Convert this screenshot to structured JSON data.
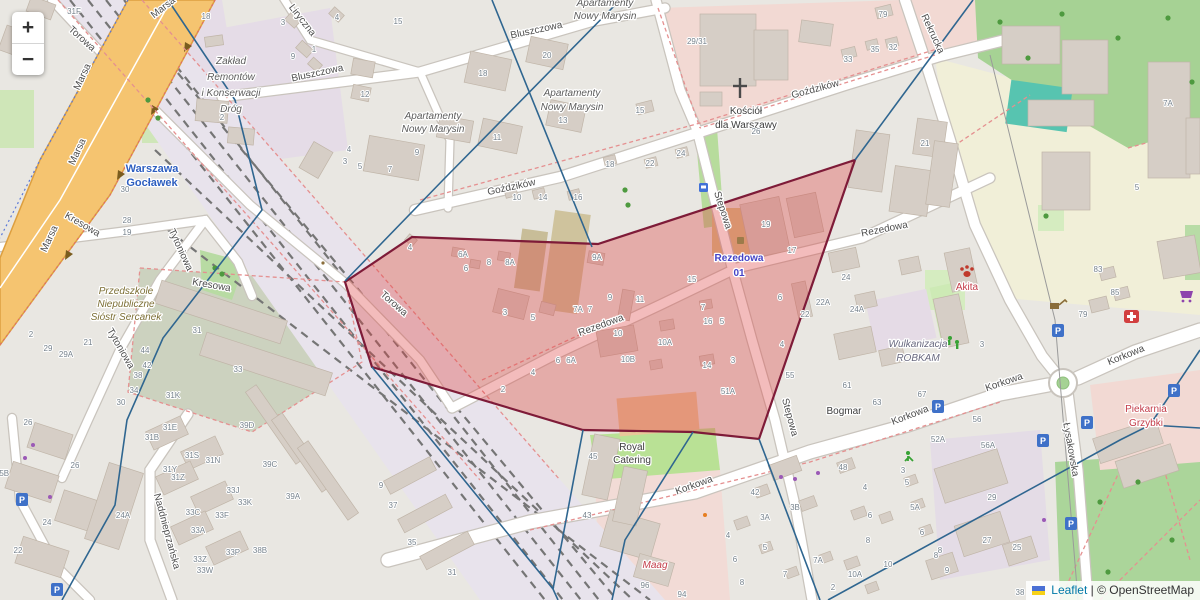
{
  "controls": {
    "zoom_in": "+",
    "zoom_out": "−"
  },
  "attribution": {
    "leaflet": "Leaflet",
    "separator": "|",
    "osm": "© OpenStreetMap"
  },
  "icons": {
    "parking_glyph": "P",
    "church_cross": "✝",
    "flag": "ukraine-flag"
  },
  "overlay": {
    "red_region_points": "345,282 412,237 598,244 855,160 759,439 693,432 583,430 372,367",
    "red_fill": "rgba(222,64,64,0.35)",
    "red_stroke": "#7e1b38",
    "line_color": "#2f6690",
    "boundary_lines": [
      "168,0 235,100 262,210 163,338 127,420 115,505 62,600",
      "620,0 443,180 345,281",
      "492,0 592,247",
      "973,0 855,160",
      "372,367 553,589 558,600",
      "583,430 553,589",
      "693,432 625,540 612,600",
      "759,439 820,600",
      "828,600 1120,440 1150,425 1200,350",
      "1150,425 1200,428"
    ]
  },
  "parkings": [
    [
      22,
      500
    ],
    [
      57,
      590
    ],
    [
      938,
      407
    ],
    [
      1043,
      441
    ],
    [
      1058,
      331
    ],
    [
      1071,
      524
    ],
    [
      1087,
      423
    ],
    [
      1174,
      391
    ]
  ],
  "streets": [
    {
      "t": "Marsa",
      "x": 165,
      "y": 10,
      "r": -38
    },
    {
      "t": "Marsa",
      "x": 85,
      "y": 78,
      "r": -65
    },
    {
      "t": "Marsa",
      "x": 80,
      "y": 153,
      "r": -65
    },
    {
      "t": "Marsa",
      "x": 52,
      "y": 240,
      "r": -65
    },
    {
      "t": "Torowa",
      "x": 80,
      "y": 41,
      "r": 42
    },
    {
      "t": "Torowa",
      "x": 392,
      "y": 306,
      "r": 41
    },
    {
      "t": "Liryczna",
      "x": 300,
      "y": 22,
      "r": 52
    },
    {
      "t": "Bluszczowa",
      "x": 318,
      "y": 76,
      "r": -12
    },
    {
      "t": "Bluszczowa",
      "x": 537,
      "y": 33,
      "r": -12
    },
    {
      "t": "Goździków",
      "x": 512,
      "y": 190,
      "r": -12
    },
    {
      "t": "Goździków",
      "x": 816,
      "y": 92,
      "r": -15
    },
    {
      "t": "Rezedowa",
      "x": 602,
      "y": 328,
      "r": -20
    },
    {
      "t": "Rezedowa",
      "x": 885,
      "y": 232,
      "r": -11
    },
    {
      "t": "Stepowa",
      "x": 720,
      "y": 211,
      "r": 72
    },
    {
      "t": "Stepowa",
      "x": 787,
      "y": 418,
      "r": 75
    },
    {
      "t": "Korkowa",
      "x": 695,
      "y": 488,
      "r": -20
    },
    {
      "t": "Korkowa",
      "x": 911,
      "y": 418,
      "r": -21
    },
    {
      "t": "Korkowa",
      "x": 1005,
      "y": 385,
      "r": -19
    },
    {
      "t": "Korkowa",
      "x": 1127,
      "y": 358,
      "r": -22
    },
    {
      "t": "Rekrucka",
      "x": 930,
      "y": 35,
      "r": 65
    },
    {
      "t": "Kresowa",
      "x": 81,
      "y": 227,
      "r": 30
    },
    {
      "t": "Kresowa",
      "x": 211,
      "y": 288,
      "r": 10
    },
    {
      "t": "Tytoniowa",
      "x": 178,
      "y": 251,
      "r": 65
    },
    {
      "t": "Tytoniowa",
      "x": 118,
      "y": 350,
      "r": 60
    },
    {
      "t": "Łysakowska",
      "x": 1068,
      "y": 450,
      "r": 80
    },
    {
      "t": "Naddnieprzańska",
      "x": 164,
      "y": 532,
      "r": 75
    }
  ],
  "pois": [
    {
      "t": "Zakład",
      "x": 231,
      "y": 64,
      "c": "g"
    },
    {
      "t": "Remontów",
      "x": 231,
      "y": 80,
      "c": "g"
    },
    {
      "t": "i Konserwacji",
      "x": 231,
      "y": 96,
      "c": "g"
    },
    {
      "t": "Dróg",
      "x": 231,
      "y": 112,
      "c": "g"
    },
    {
      "t": "Apartamenty",
      "x": 433,
      "y": 119,
      "c": "g"
    },
    {
      "t": "Nowy Marysin",
      "x": 433,
      "y": 132,
      "c": "g"
    },
    {
      "t": "Apartamenty",
      "x": 572,
      "y": 96,
      "c": "g"
    },
    {
      "t": "Nowy Marysin",
      "x": 572,
      "y": 110,
      "c": "g"
    },
    {
      "t": "Apartamenty",
      "x": 605,
      "y": 6,
      "c": "g"
    },
    {
      "t": "Nowy Marysin",
      "x": 605,
      "y": 19,
      "c": "g"
    },
    {
      "t": "Kościół",
      "x": 746,
      "y": 114,
      "c": "d"
    },
    {
      "t": "dla Warszawy",
      "x": 746,
      "y": 128,
      "c": "d"
    },
    {
      "t": "Warszawa",
      "x": 152,
      "y": 172,
      "c": "bl"
    },
    {
      "t": "Gocławek",
      "x": 152,
      "y": 186,
      "c": "bl"
    },
    {
      "t": "Przedszkole",
      "x": 126,
      "y": 294,
      "c": "br"
    },
    {
      "t": "Niepubliczne",
      "x": 126,
      "y": 307,
      "c": "br"
    },
    {
      "t": "Sióstr Sercanek",
      "x": 126,
      "y": 320,
      "c": "br"
    },
    {
      "t": "Rezedowa",
      "x": 739,
      "y": 261,
      "c": "stp"
    },
    {
      "t": "01",
      "x": 739,
      "y": 276,
      "c": "stp"
    },
    {
      "t": "Royal",
      "x": 632,
      "y": 450,
      "c": "d"
    },
    {
      "t": "Catering",
      "x": 632,
      "y": 463,
      "c": "d"
    },
    {
      "t": "Bogmar",
      "x": 844,
      "y": 414,
      "c": "d"
    },
    {
      "t": "Wulkanizacja",
      "x": 918,
      "y": 347,
      "c": "ind"
    },
    {
      "t": "ROBKAM",
      "x": 918,
      "y": 361,
      "c": "ind"
    },
    {
      "t": "Akita",
      "x": 967,
      "y": 290,
      "c": "rd"
    },
    {
      "t": "Piekarnia",
      "x": 1146,
      "y": 412,
      "c": "rd"
    },
    {
      "t": "Grzybki",
      "x": 1146,
      "y": 426,
      "c": "rd"
    },
    {
      "t": "Maag",
      "x": 655,
      "y": 568,
      "c": "rdi"
    }
  ],
  "numbers": [
    [
      74,
      14,
      "31F"
    ],
    [
      206,
      19,
      "18"
    ],
    [
      283,
      25,
      "3"
    ],
    [
      337,
      20,
      "4"
    ],
    [
      398,
      24,
      "15"
    ],
    [
      293,
      59,
      "9"
    ],
    [
      314,
      52,
      "1"
    ],
    [
      222,
      120,
      "2"
    ],
    [
      365,
      97,
      "12"
    ],
    [
      349,
      152,
      "4"
    ],
    [
      345,
      164,
      "3"
    ],
    [
      360,
      169,
      "5"
    ],
    [
      390,
      172,
      "7"
    ],
    [
      417,
      155,
      "9"
    ],
    [
      483,
      76,
      "18"
    ],
    [
      547,
      58,
      "20"
    ],
    [
      497,
      140,
      "11"
    ],
    [
      563,
      123,
      "13"
    ],
    [
      517,
      200,
      "10"
    ],
    [
      543,
      200,
      "14"
    ],
    [
      578,
      200,
      "16"
    ],
    [
      640,
      113,
      "15"
    ],
    [
      610,
      167,
      "18"
    ],
    [
      650,
      166,
      "22"
    ],
    [
      681,
      156,
      "24"
    ],
    [
      756,
      134,
      "26"
    ],
    [
      848,
      62,
      "33"
    ],
    [
      875,
      52,
      "35"
    ],
    [
      893,
      50,
      "32"
    ],
    [
      883,
      17,
      "79"
    ],
    [
      925,
      146,
      "21"
    ],
    [
      1168,
      106,
      "7A"
    ],
    [
      1137,
      190,
      "5"
    ],
    [
      697,
      44,
      "29/31"
    ],
    [
      410,
      250,
      "4"
    ],
    [
      463,
      257,
      "6A"
    ],
    [
      466,
      271,
      "6"
    ],
    [
      489,
      265,
      "8"
    ],
    [
      510,
      265,
      "8A"
    ],
    [
      597,
      260,
      "9A"
    ],
    [
      610,
      300,
      "9"
    ],
    [
      578,
      312,
      "7A"
    ],
    [
      590,
      312,
      "7"
    ],
    [
      640,
      302,
      "11"
    ],
    [
      692,
      282,
      "15"
    ],
    [
      703,
      310,
      "7"
    ],
    [
      708,
      324,
      "16"
    ],
    [
      722,
      324,
      "5"
    ],
    [
      618,
      336,
      "10"
    ],
    [
      665,
      345,
      "10A"
    ],
    [
      628,
      362,
      "10B"
    ],
    [
      707,
      368,
      "14"
    ],
    [
      733,
      363,
      "3"
    ],
    [
      728,
      394,
      "51A"
    ],
    [
      505,
      315,
      "3"
    ],
    [
      533,
      320,
      "5"
    ],
    [
      558,
      363,
      "6"
    ],
    [
      571,
      363,
      "6A"
    ],
    [
      533,
      375,
      "4"
    ],
    [
      503,
      392,
      "2"
    ],
    [
      766,
      227,
      "19"
    ],
    [
      792,
      253,
      "17"
    ],
    [
      846,
      280,
      "24"
    ],
    [
      857,
      312,
      "24A"
    ],
    [
      823,
      305,
      "22A"
    ],
    [
      805,
      317,
      "22"
    ],
    [
      780,
      300,
      "6"
    ],
    [
      782,
      347,
      "4"
    ],
    [
      790,
      378,
      "55"
    ],
    [
      847,
      388,
      "61"
    ],
    [
      127,
      223,
      "28"
    ],
    [
      127,
      235,
      "19"
    ],
    [
      125,
      192,
      "30"
    ],
    [
      31,
      337,
      "2"
    ],
    [
      48,
      351,
      "29"
    ],
    [
      66,
      357,
      "29A"
    ],
    [
      88,
      345,
      "21"
    ],
    [
      197,
      333,
      "31"
    ],
    [
      238,
      372,
      "33"
    ],
    [
      173,
      398,
      "31K"
    ],
    [
      145,
      353,
      "44"
    ],
    [
      147,
      368,
      "42"
    ],
    [
      138,
      378,
      "38"
    ],
    [
      134,
      393,
      "34"
    ],
    [
      121,
      405,
      "30"
    ],
    [
      28,
      425,
      "26"
    ],
    [
      2,
      476,
      "25B"
    ],
    [
      75,
      468,
      "26"
    ],
    [
      47,
      525,
      "24"
    ],
    [
      18,
      553,
      "22"
    ],
    [
      123,
      518,
      "24A"
    ],
    [
      152,
      440,
      "31B"
    ],
    [
      170,
      430,
      "31E"
    ],
    [
      170,
      472,
      "31Y"
    ],
    [
      178,
      480,
      "31Z"
    ],
    [
      192,
      458,
      "31S"
    ],
    [
      213,
      463,
      "31N"
    ],
    [
      233,
      493,
      "33J"
    ],
    [
      245,
      505,
      "33K"
    ],
    [
      193,
      515,
      "33C"
    ],
    [
      222,
      518,
      "33F"
    ],
    [
      198,
      533,
      "33A"
    ],
    [
      233,
      555,
      "33P"
    ],
    [
      200,
      562,
      "33Z"
    ],
    [
      205,
      573,
      "33W"
    ],
    [
      247,
      428,
      "39D"
    ],
    [
      270,
      467,
      "39C"
    ],
    [
      293,
      499,
      "39A"
    ],
    [
      260,
      553,
      "38B"
    ],
    [
      381,
      488,
      "9"
    ],
    [
      393,
      508,
      "37"
    ],
    [
      412,
      545,
      "35"
    ],
    [
      452,
      575,
      "31"
    ],
    [
      593,
      459,
      "45"
    ],
    [
      587,
      518,
      "43"
    ],
    [
      645,
      588,
      "96"
    ],
    [
      682,
      597,
      "94"
    ],
    [
      755,
      495,
      "42"
    ],
    [
      765,
      520,
      "3A"
    ],
    [
      795,
      510,
      "3B"
    ],
    [
      843,
      470,
      "48"
    ],
    [
      865,
      490,
      "4"
    ],
    [
      870,
      518,
      "6"
    ],
    [
      868,
      543,
      "8"
    ],
    [
      818,
      563,
      "7A"
    ],
    [
      833,
      590,
      "2"
    ],
    [
      855,
      577,
      "10A"
    ],
    [
      888,
      567,
      "10"
    ],
    [
      765,
      550,
      "5"
    ],
    [
      785,
      577,
      "7"
    ],
    [
      728,
      538,
      "4"
    ],
    [
      735,
      562,
      "6"
    ],
    [
      742,
      585,
      "8"
    ],
    [
      903,
      473,
      "3"
    ],
    [
      907,
      485,
      "5"
    ],
    [
      915,
      510,
      "5A"
    ],
    [
      922,
      535,
      "6"
    ],
    [
      936,
      558,
      "8"
    ],
    [
      938,
      442,
      "52A"
    ],
    [
      988,
      448,
      "56A"
    ],
    [
      992,
      500,
      "29"
    ],
    [
      987,
      543,
      "27"
    ],
    [
      1017,
      550,
      "25"
    ],
    [
      947,
      573,
      "9"
    ],
    [
      1020,
      595,
      "38"
    ],
    [
      940,
      553,
      "8"
    ],
    [
      982,
      347,
      "3"
    ],
    [
      922,
      397,
      "67"
    ],
    [
      877,
      405,
      "63"
    ],
    [
      977,
      422,
      "56"
    ],
    [
      1083,
      317,
      "79"
    ],
    [
      1098,
      272,
      "83"
    ],
    [
      1115,
      295,
      "85"
    ]
  ]
}
